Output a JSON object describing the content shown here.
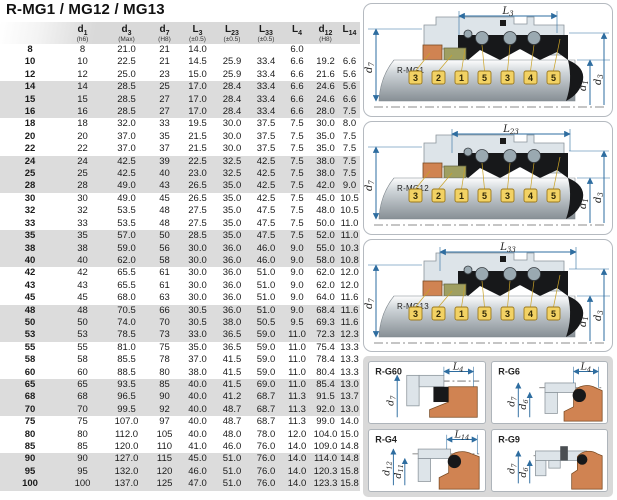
{
  "title": "R-MG1 / MG12 / MG13",
  "colors": {
    "accent_blue": "#2e6da0",
    "rubber_orange": "#d08352",
    "olive": "#9f9f62",
    "tag_yellow": "#f2d264",
    "tag_border": "#9c7a1e",
    "black_part": "#17181a",
    "metal_light": "#dde4e9",
    "stripe_gray": "#dcdcdc",
    "header_gray": "#d9d9d9",
    "leader_gold": "#c9a227"
  },
  "table": {
    "headers": [
      {
        "base": "",
        "sub": "",
        "note": ""
      },
      {
        "base": "d",
        "sub": "1",
        "note": "(h6)"
      },
      {
        "base": "d",
        "sub": "3",
        "note": "(Max)"
      },
      {
        "base": "d",
        "sub": "7",
        "note": "(H8)"
      },
      {
        "base": "L",
        "sub": "3",
        "note": "(±0.5)"
      },
      {
        "base": "L",
        "sub": "23",
        "note": "(±0.5)"
      },
      {
        "base": "L",
        "sub": "33",
        "note": "(±0.5)"
      },
      {
        "base": "L",
        "sub": "4",
        "note": ""
      },
      {
        "base": "d",
        "sub": "12",
        "note": "(H8)"
      },
      {
        "base": "L",
        "sub": "14",
        "note": ""
      }
    ],
    "rows": [
      [
        "8",
        "8",
        "21.0",
        "21",
        "14.0",
        "",
        "",
        "6.0",
        "",
        ""
      ],
      [
        "10",
        "10",
        "22.5",
        "21",
        "14.5",
        "25.9",
        "33.4",
        "6.6",
        "19.2",
        "6.6"
      ],
      [
        "12",
        "12",
        "25.0",
        "23",
        "15.0",
        "25.9",
        "33.4",
        "6.6",
        "21.6",
        "5.6"
      ],
      [
        "14",
        "14",
        "28.5",
        "25",
        "17.0",
        "28.4",
        "33.4",
        "6.6",
        "24.6",
        "5.6"
      ],
      [
        "15",
        "15",
        "28.5",
        "27",
        "17.0",
        "28.4",
        "33.4",
        "6.6",
        "24.6",
        "6.6"
      ],
      [
        "16",
        "16",
        "28.5",
        "27",
        "17.0",
        "28.4",
        "33.4",
        "6.6",
        "28.0",
        "7.5"
      ],
      [
        "18",
        "18",
        "32.0",
        "33",
        "19.5",
        "30.0",
        "37.5",
        "7.5",
        "30.0",
        "8.0"
      ],
      [
        "20",
        "20",
        "37.0",
        "35",
        "21.5",
        "30.0",
        "37.5",
        "7.5",
        "35.0",
        "7.5"
      ],
      [
        "22",
        "22",
        "37.0",
        "37",
        "21.5",
        "30.0",
        "37.5",
        "7.5",
        "35.0",
        "7.5"
      ],
      [
        "24",
        "24",
        "42.5",
        "39",
        "22.5",
        "32.5",
        "42.5",
        "7.5",
        "38.0",
        "7.5"
      ],
      [
        "25",
        "25",
        "42.5",
        "40",
        "23.0",
        "32.5",
        "42.5",
        "7.5",
        "38.0",
        "7.5"
      ],
      [
        "28",
        "28",
        "49.0",
        "43",
        "26.5",
        "35.0",
        "42.5",
        "7.5",
        "42.0",
        "9.0"
      ],
      [
        "30",
        "30",
        "49.0",
        "45",
        "26.5",
        "35.0",
        "42.5",
        "7.5",
        "45.0",
        "10.5"
      ],
      [
        "32",
        "32",
        "53.5",
        "48",
        "27.5",
        "35.0",
        "47.5",
        "7.5",
        "48.0",
        "10.5"
      ],
      [
        "33",
        "33",
        "53.5",
        "48",
        "27.5",
        "35.0",
        "47.5",
        "7.5",
        "50.0",
        "11.0"
      ],
      [
        "35",
        "35",
        "57.0",
        "50",
        "28.5",
        "35.0",
        "47.5",
        "7.5",
        "52.0",
        "11.0"
      ],
      [
        "38",
        "38",
        "59.0",
        "56",
        "30.0",
        "36.0",
        "46.0",
        "9.0",
        "55.0",
        "10.3"
      ],
      [
        "40",
        "40",
        "62.0",
        "58",
        "30.0",
        "36.0",
        "46.0",
        "9.0",
        "58.0",
        "10.8"
      ],
      [
        "42",
        "42",
        "65.5",
        "61",
        "30.0",
        "36.0",
        "51.0",
        "9.0",
        "62.0",
        "12.0"
      ],
      [
        "43",
        "43",
        "65.5",
        "61",
        "30.0",
        "36.0",
        "51.0",
        "9.0",
        "62.0",
        "12.0"
      ],
      [
        "45",
        "45",
        "68.0",
        "63",
        "30.0",
        "36.0",
        "51.0",
        "9.0",
        "64.0",
        "11.6"
      ],
      [
        "48",
        "48",
        "70.5",
        "66",
        "30.5",
        "36.0",
        "51.0",
        "9.0",
        "68.4",
        "11.6"
      ],
      [
        "50",
        "50",
        "74.0",
        "70",
        "30.5",
        "38.0",
        "50.5",
        "9.5",
        "69.3",
        "11.6"
      ],
      [
        "53",
        "53",
        "78.5",
        "73",
        "33.0",
        "36.5",
        "59.0",
        "11.0",
        "72.3",
        "12.3"
      ],
      [
        "55",
        "55",
        "81.0",
        "75",
        "35.0",
        "36.5",
        "59.0",
        "11.0",
        "75.4",
        "13.3"
      ],
      [
        "58",
        "58",
        "85.5",
        "78",
        "37.0",
        "41.5",
        "59.0",
        "11.0",
        "78.4",
        "13.3"
      ],
      [
        "60",
        "60",
        "88.5",
        "80",
        "38.0",
        "41.5",
        "59.0",
        "11.0",
        "80.4",
        "13.3"
      ],
      [
        "65",
        "65",
        "93.5",
        "85",
        "40.0",
        "41.5",
        "69.0",
        "11.0",
        "85.4",
        "13.0"
      ],
      [
        "68",
        "68",
        "96.5",
        "90",
        "40.0",
        "41.2",
        "68.7",
        "11.3",
        "91.5",
        "13.7"
      ],
      [
        "70",
        "70",
        "99.5",
        "92",
        "40.0",
        "48.7",
        "68.7",
        "11.3",
        "92.0",
        "13.0"
      ],
      [
        "75",
        "75",
        "107.0",
        "97",
        "40.0",
        "48.7",
        "68.7",
        "11.3",
        "99.0",
        "14.0"
      ],
      [
        "80",
        "80",
        "112.0",
        "105",
        "40.0",
        "48.0",
        "78.0",
        "12.0",
        "104.0",
        "15.0"
      ],
      [
        "85",
        "85",
        "120.0",
        "110",
        "41.0",
        "46.0",
        "76.0",
        "14.0",
        "109.0",
        "14.8"
      ],
      [
        "90",
        "90",
        "127.0",
        "115",
        "45.0",
        "51.0",
        "76.0",
        "14.0",
        "114.0",
        "14.8"
      ],
      [
        "95",
        "95",
        "132.0",
        "120",
        "46.0",
        "51.0",
        "76.0",
        "14.0",
        "120.3",
        "15.8"
      ],
      [
        "100",
        "100",
        "137.0",
        "125",
        "47.0",
        "51.0",
        "76.0",
        "14.0",
        "123.3",
        "15.8"
      ]
    ]
  },
  "diagrams": {
    "tags": [
      "3",
      "2",
      "1",
      "5",
      "3",
      "4",
      "5"
    ],
    "left_dim": {
      "base": "d",
      "sub": "7"
    },
    "right_dims": [
      {
        "base": "d",
        "sub": "1"
      },
      {
        "base": "d",
        "sub": "3"
      }
    ],
    "mg1": {
      "label": "R-MG1",
      "dim": {
        "base": "L",
        "sub": "3"
      }
    },
    "mg12": {
      "label": "R-MG12",
      "dim": {
        "base": "L",
        "sub": "23"
      }
    },
    "mg13": {
      "label": "R-MG13",
      "dim": {
        "base": "L",
        "sub": "33"
      }
    }
  },
  "details": [
    {
      "label": "R-G60",
      "top": {
        "base": "L",
        "sub": "4"
      },
      "left": [
        {
          "base": "d",
          "sub": "7"
        }
      ]
    },
    {
      "label": "R-G6",
      "top": {
        "base": "L",
        "sub": "4"
      },
      "left": [
        {
          "base": "d",
          "sub": "7"
        },
        {
          "base": "d",
          "sub": "6"
        }
      ]
    },
    {
      "label": "R-G4",
      "top": {
        "base": "L",
        "sub": "14"
      },
      "left": [
        {
          "base": "d",
          "sub": "12"
        },
        {
          "base": "d",
          "sub": "11"
        }
      ]
    },
    {
      "label": "R-G9",
      "top": null,
      "left": [
        {
          "base": "d",
          "sub": "7"
        },
        {
          "base": "d",
          "sub": "6"
        }
      ]
    }
  ]
}
